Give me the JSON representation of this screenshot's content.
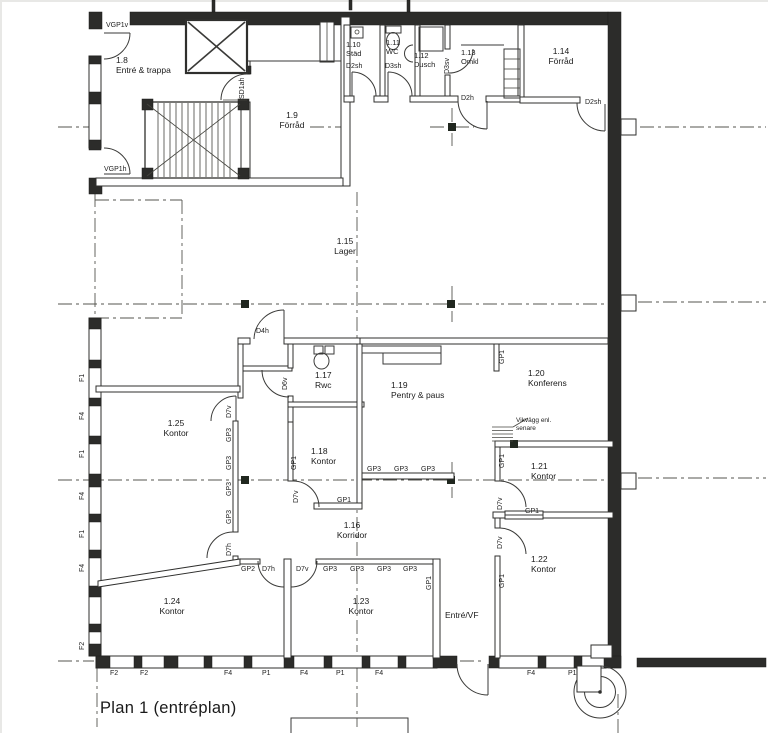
{
  "drawing_title": "Plan 1 (entréplan)",
  "rooms": {
    "entre_trappa": {
      "num": "1.8",
      "name": "Entré & trappa"
    },
    "forrad_19": {
      "num": "1.9",
      "name": "Förråd"
    },
    "stad": {
      "num": "1.10",
      "name": "Städ"
    },
    "wc": {
      "num": "1.11",
      "name": "WC"
    },
    "dusch": {
      "num": "1.12",
      "name": "Dusch"
    },
    "omkl": {
      "num": "1.13",
      "name": "Omkl"
    },
    "forrad_114": {
      "num": "1.14",
      "name": "Förråd"
    },
    "lager": {
      "num": "1.15",
      "name": "Lager"
    },
    "korridor": {
      "num": "1.16",
      "name": "Korridor"
    },
    "rwc": {
      "num": "1.17",
      "name": "Rwc"
    },
    "kontor_118": {
      "num": "1.18",
      "name": "Kontor"
    },
    "pentry": {
      "num": "1.19",
      "name": "Pentry & paus"
    },
    "konferens": {
      "num": "1.20",
      "name": "Konferens"
    },
    "kontor_121": {
      "num": "1.21",
      "name": "Kontor"
    },
    "kontor_122": {
      "num": "1.22",
      "name": "Kontor"
    },
    "kontor_123": {
      "num": "1.23",
      "name": "Kontor"
    },
    "kontor_124": {
      "num": "1.24",
      "name": "Kontor"
    },
    "kontor_125": {
      "num": "1.25",
      "name": "Kontor"
    },
    "entre_vf": {
      "name": "Entré/VF"
    }
  },
  "codes": {
    "vgp1v": "VGP1v",
    "vgp1h": "VGP1h",
    "sd1ah": "SD1ah",
    "d2sh": "D2sh",
    "d3sh": "D3sh",
    "d3sv": "D3sv",
    "d2h": "D2h",
    "d4h": "D4h",
    "d6v": "D6v",
    "d7v": "D7v",
    "d7h": "D7h",
    "gp1": "GP1",
    "gp2": "GP2",
    "gp3": "GP3"
  },
  "window_codes": {
    "f1": "F1",
    "f2": "F2",
    "f4": "F4",
    "p1": "P1"
  },
  "annotation": {
    "vikvagg_line1": "Vikvägg enl.",
    "vikvagg_line2": "senare"
  },
  "colors": {
    "line": "#2f2f2d",
    "wall_dark": "#2c2c2a",
    "paper": "#ffffff"
  }
}
